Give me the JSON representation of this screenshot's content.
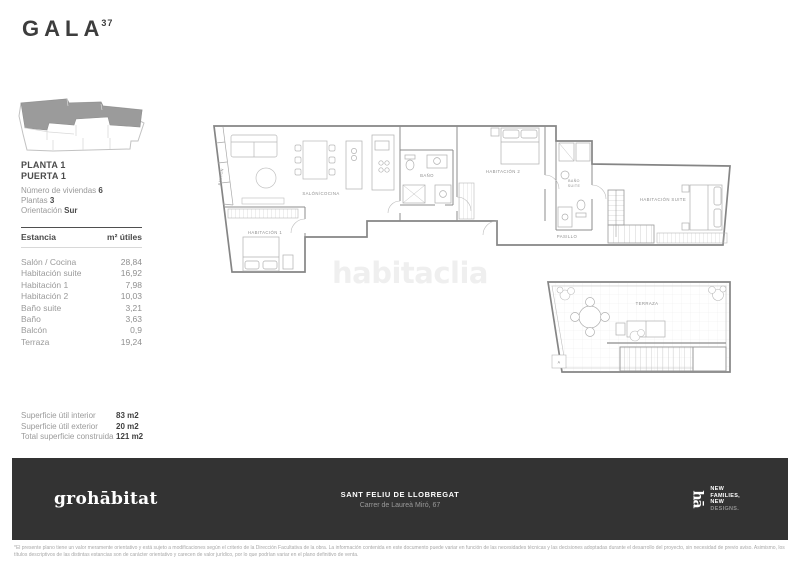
{
  "brand": {
    "name": "GALA",
    "superscript": "37"
  },
  "sidebar": {
    "floor": "PLANTA 1",
    "door": "PUERTA 1",
    "facts": [
      {
        "label": "Número de viviendas ",
        "value": "6"
      },
      {
        "label": "Plantas ",
        "value": "3"
      },
      {
        "label": "Orientación ",
        "value": "Sur"
      }
    ],
    "table": {
      "headers": [
        "Estancia",
        "m² útiles"
      ],
      "rows": [
        {
          "name": "Salón / Cocina",
          "value": "28,84"
        },
        {
          "name": "Habitación suite",
          "value": "16,92"
        },
        {
          "name": "Habitación 1",
          "value": "7,98"
        },
        {
          "name": "Habitación 2",
          "value": "10,03"
        },
        {
          "name": "Baño suite",
          "value": "3,21"
        },
        {
          "name": "Baño",
          "value": "3,63"
        },
        {
          "name": "Balcón",
          "value": "0,9"
        },
        {
          "name": "Terraza",
          "value": "19,24"
        }
      ]
    },
    "summary": [
      {
        "label": "Superficie útil interior",
        "value": "83 m2"
      },
      {
        "label": "Superficie útil exterior",
        "value": "20 m2"
      },
      {
        "label": "Total superficie construida",
        "value": "121 m2"
      }
    ]
  },
  "plan": {
    "watermark": "habitaclia",
    "labels": {
      "balcon": "BALCÓN",
      "salon_cocina": "SALÓN/COCINA",
      "habitacion_1": "HABITACIÓN 1",
      "bano": "BAÑO",
      "habitacion_2": "HABITACIÓN 2",
      "bano_suite_1": "BAÑO",
      "bano_suite_2": "SUITE",
      "pasillo": "PASILLO",
      "habitacion_suite": "HABITACIÓN SUITE",
      "terraza": "TERRAZA",
      "terrace_marker": "A"
    }
  },
  "footer": {
    "logo": "grohābitat",
    "location": "SANT FELIU DE LLOBREGAT",
    "address": "Carrer de Laureà Miró, 67",
    "badge": {
      "monogram": "hā",
      "line1": "NEW",
      "line2": "FAMILIES,",
      "line3": "NEW",
      "line4": "DESIGNS."
    }
  },
  "disclaimer": {
    "line1": "*El presente plano tiene un valor meramente orientativo y está sujeto a modificaciones según el criterio de la Dirección Facultativa de la obra.  La información contenida en este documento puede variar en función de las necesidades técnicas y las decisiones adoptadas durante el desarrollo  del proyecto, sin necesidad de previo aviso.  Asimismo, los",
    "line2": "títulos descriptivos de las distintas estancias son de carácter orientativo y carecen de valor jurídico, por lo que podrían variar en el plano definitivo de venta."
  },
  "colors": {
    "footer_bg": "#333333",
    "text_dark": "#3d3d3d",
    "text_gray": "#9a9a9a",
    "wall": "#8c8c8c",
    "site_fill": "#9b9b9b",
    "watermark": "#efefef"
  }
}
